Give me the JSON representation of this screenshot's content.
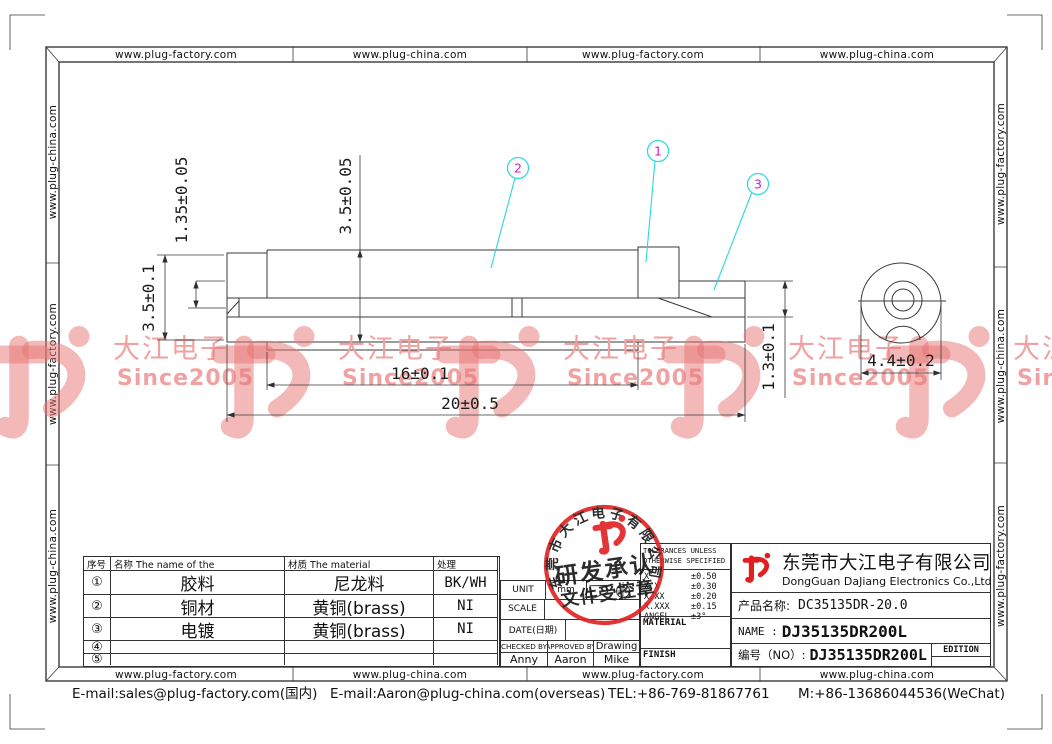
{
  "page": {
    "borders": {
      "top": [
        "www.plug-factory.com",
        "www.plug-china.com",
        "www.plug-factory.com",
        "www.plug-china.com"
      ],
      "bottom": [
        "www.plug-factory.com",
        "www.plug-china.com",
        "www.plug-factory.com",
        "www.plug-china.com"
      ],
      "left": [
        "www.plug-china.com",
        "www.plug-factory.com",
        "www.plug-china.com"
      ],
      "right": [
        "www.plug-factory.com",
        "www.plug-china.com",
        "www.plug-factory.com"
      ]
    },
    "footer": {
      "email_cn": "E-mail:sales@plug-factory.com(国内)",
      "email_overseas": "E-mail:Aaron@plug-china.com(overseas)",
      "tel": "TEL:+86-769-81867761",
      "mobile": "M:+86-13686044536(WeChat)"
    }
  },
  "watermark": {
    "brand": "大江电子",
    "since": "Since2005",
    "color": "#f0a2a2"
  },
  "drawing": {
    "dims": {
      "flange_wall": "1.35±0.05",
      "body_od": "3.5±0.05",
      "left_od": "3.5±0.1",
      "body_len": "16±0.1",
      "total_len": "20±0.5",
      "tube_id": "1.3±0.1",
      "end_od": "4.4±0.2"
    },
    "callouts": {
      "c1": "1",
      "c2": "2",
      "c3": "3"
    },
    "colors": {
      "leader": "#2bd8d8",
      "callout_number": "#cf1fcf",
      "stamp_red": "#e02020",
      "line": "#3a3a3a"
    }
  },
  "parts_table": {
    "headers": {
      "no": "序号",
      "name": "名称 The name of the",
      "material": "材质 The material",
      "finish": "处理"
    },
    "rows": [
      {
        "no": "①",
        "name": "胶料",
        "material": "尼龙料",
        "finish": "BK/WH"
      },
      {
        "no": "②",
        "name": "铜材",
        "material": "黄铜(brass)",
        "finish": "NI"
      },
      {
        "no": "③",
        "name": "电镀",
        "material": "黄铜(brass)",
        "finish": "NI"
      },
      {
        "no": "④",
        "name": "",
        "material": "",
        "finish": ""
      },
      {
        "no": "⑤",
        "name": "",
        "material": "",
        "finish": ""
      }
    ]
  },
  "info_block": {
    "unit_label": "UNIT",
    "unit_value": "mm",
    "scale_label": "SCALE",
    "date_label": "DATE(日期)",
    "checked_label": "CHECKED BY",
    "approved_label": "APPROVED BY",
    "drawing_label": "Drawing",
    "checked_by": "Anny",
    "approved_by": "Aaron",
    "drawn_by": "Mike"
  },
  "tolerance_block": {
    "title1": "TOLERANCES UNLESS",
    "title2": "OTHERWISE SPECIFIED",
    "rows": [
      {
        "label": "X",
        "value": "±0.50"
      },
      {
        "label": "X.X",
        "value": "±0.30"
      },
      {
        "label": "X.XX",
        "value": "±0.20"
      },
      {
        "label": "X.XXX",
        "value": "±0.15"
      },
      {
        "label": "ANGEL",
        "value": "±3°"
      }
    ],
    "material_label": "MATERIAL",
    "finish_label": "FINISH"
  },
  "title_block": {
    "company_cn": "东莞市大江电子有限公司",
    "company_en": "DongGuan DaJiang Electronics Co.,Ltd",
    "product_label": "产品名称:",
    "product_value": "DC35135DR-20.0",
    "name_label": "NAME :",
    "name_value": "DJ35135DR200L",
    "no_label": "编号（NO）:",
    "no_value": "DJ35135DR200L",
    "edition_label": "EDITION"
  },
  "stamp": {
    "ring_text": "东莞市大江电子有限公司",
    "line1": "研发承认",
    "line2": "文件受控章"
  }
}
